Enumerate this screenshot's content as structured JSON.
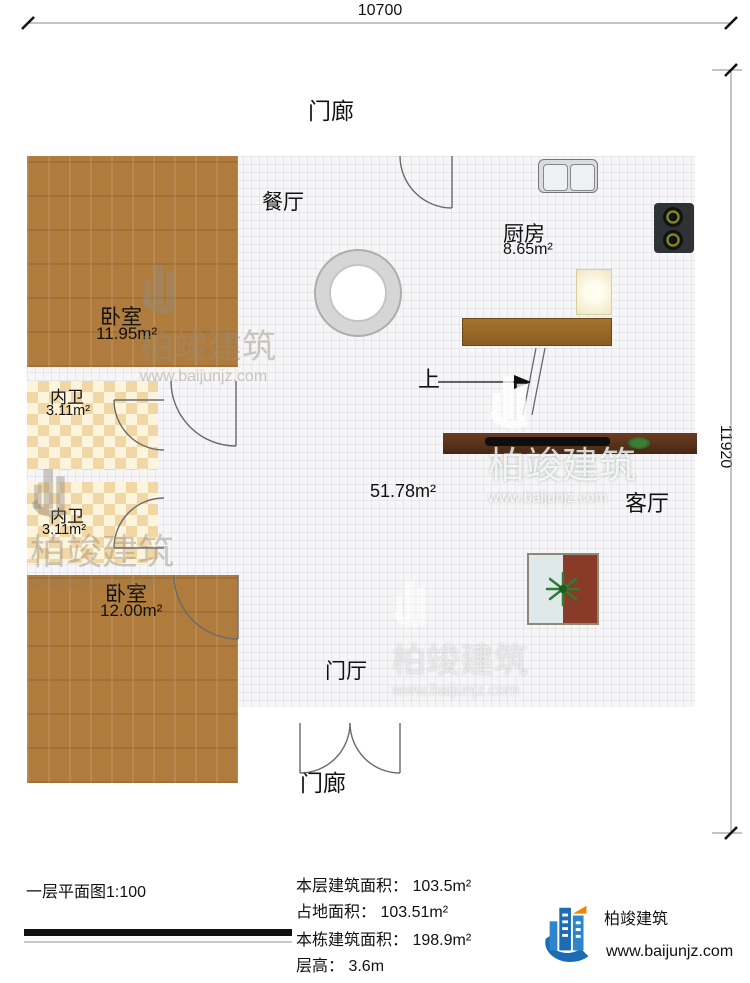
{
  "dimensions": {
    "top": "10700",
    "right": "11920"
  },
  "rooms": {
    "porch_top": {
      "label": "门廊"
    },
    "porch_bottom": {
      "label": "门廊"
    },
    "dining": {
      "label": "餐厅"
    },
    "kitchen": {
      "label": "厨房",
      "area": "8.65m²"
    },
    "bedroom1": {
      "label": "卧室",
      "area": "11.95m²"
    },
    "bath1": {
      "label": "内卫",
      "area": "3.11m²"
    },
    "bath2": {
      "label": "内卫",
      "area": "3.11m²"
    },
    "bedroom2": {
      "label": "卧室",
      "area": "12.00m²"
    },
    "living": {
      "label": "客厅"
    },
    "foyer": {
      "label": "门厅"
    },
    "central_area": "51.78m²",
    "stairs": {
      "up_label": "上"
    }
  },
  "watermark": {
    "brand": "柏竣建筑",
    "url": "www.baijunjz.com"
  },
  "title_block": {
    "title": "一层平面图",
    "scale": "1:100",
    "stats": [
      "本层建筑面积： 103.5m²",
      "占地面积： 103.51m²",
      "本栋建筑面积： 198.9m²",
      "层高： 3.6m"
    ]
  },
  "logo": {
    "brand": "柏竣建筑",
    "url": "www.baijunjz.com",
    "colors": {
      "blue": "#1b6cb5",
      "light_blue": "#2e86c8",
      "orange": "#f08300"
    }
  }
}
